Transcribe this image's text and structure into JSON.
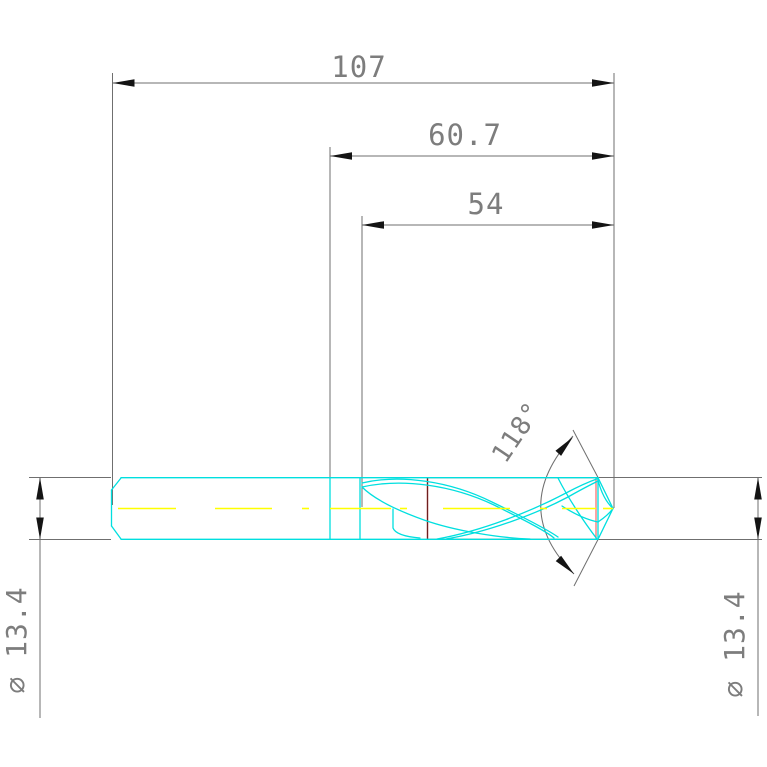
{
  "title": "Twist drill dimensioned technical drawing",
  "dims": {
    "overall_length": {
      "label": "107",
      "value": 107,
      "unit": "mm"
    },
    "flute_length": {
      "label": "60.7",
      "value": 60.7,
      "unit": "mm"
    },
    "cutting_length": {
      "label": "54",
      "value": 54,
      "unit": "mm"
    },
    "point_angle": {
      "label": "118°",
      "value": 118,
      "unit": "deg"
    },
    "diameter_left": {
      "label": "∅ 13.4",
      "value": 13.4,
      "unit": "mm"
    },
    "diameter_right": {
      "label": "∅ 13.4",
      "value": 13.4,
      "unit": "mm"
    }
  },
  "colors": {
    "background": "#ffffff",
    "dim_line": "#6f6f6f",
    "arrow": "#141414",
    "text": "#7d7d7d",
    "outline_cyan": "#00dfdf",
    "centerline_yellow": "#ffff00",
    "highlight_red": "#f87474",
    "highlight_maroon": "#6e1f1f"
  }
}
